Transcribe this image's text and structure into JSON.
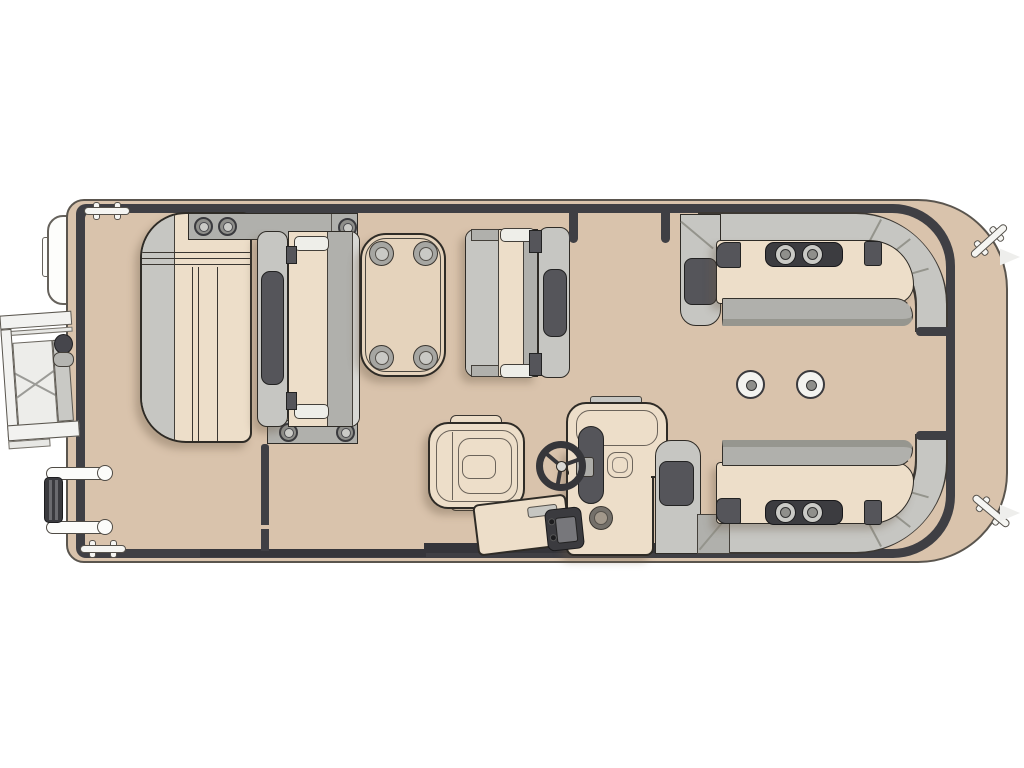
{
  "diagram": {
    "type": "pontoon-boat-floor-plan",
    "view": "top-down",
    "background_color": "#ffffff",
    "colors": {
      "deck": "#d9c3ac",
      "rail": "#3f3f44",
      "cream": "#eddec9",
      "gLight": "#c6c6c2",
      "gMed": "#b0b0ac",
      "gDark": "#55555a",
      "table": "#e5d3bc"
    },
    "components": {
      "bow_port_side": [
        "chaise-lounge",
        "bench-seat-facing-right",
        "rectangular-table",
        "bench-seat-facing-left"
      ],
      "helm": [
        "captain-swivel-chair",
        "helm-console",
        "steering-wheel",
        "stereo-unit",
        "console-cup-holder",
        "boarding-step"
      ],
      "stern_section": [
        "l-shaped-lounge-top",
        "l-shaped-lounge-bottom",
        "armrest-cup-holder-units",
        "deck-pedestal-mounts"
      ],
      "exterior": [
        "swim-gate-ramp",
        "gate-hinge",
        "folding-boarding-ladder",
        "mooring-cleats",
        "side-accessory",
        "hull-fence-rail"
      ]
    },
    "counts": {
      "table_cup_holders": 4,
      "lounge_cup_holders": 4,
      "pedestal_mounts": 2,
      "cleats": 4,
      "gate_posts": 2,
      "ladder_rails": 2
    }
  }
}
